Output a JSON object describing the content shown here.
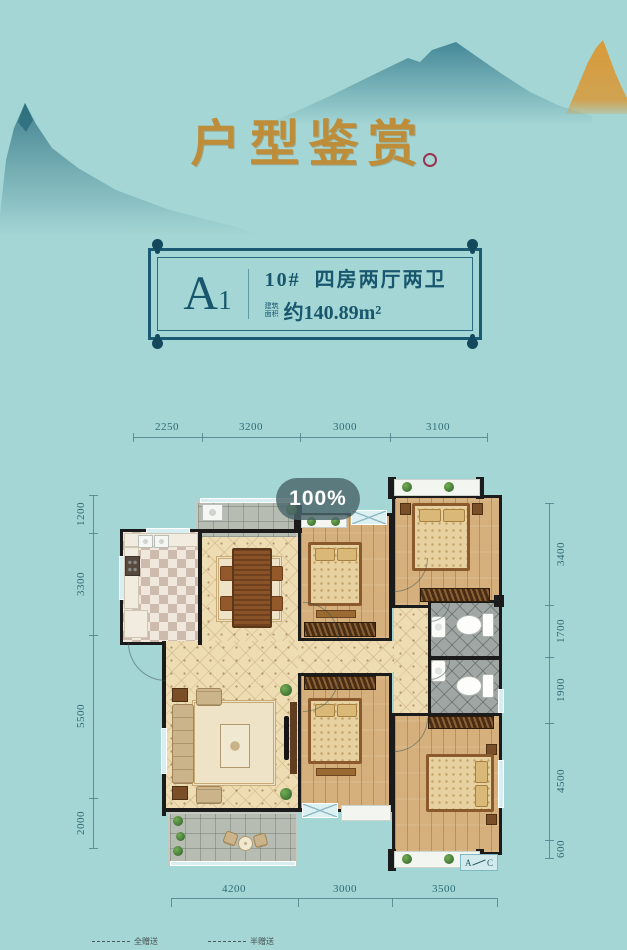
{
  "page": {
    "background": "#a4d6d5",
    "accent_gold": "#bd8d3a",
    "ink_teal": "#17566c"
  },
  "header": {
    "title": "户型鉴赏"
  },
  "unit_card": {
    "code_main": "A",
    "code_sub": "1",
    "title": "10#  四房两厅两卫",
    "area_label_line1": "建筑",
    "area_label_line2": "面积",
    "area_value": "约140.89m²"
  },
  "loader": {
    "progress": "100%"
  },
  "plan": {
    "dims_top": [
      "2250",
      "3200",
      "3000",
      "3100"
    ],
    "dims_left": [
      "1200",
      "3300",
      "5500",
      "2000"
    ],
    "dims_right": [
      "3400",
      "1700",
      "1900",
      "4500",
      "600"
    ],
    "dims_bottom": [
      "4200",
      "3000",
      "3500"
    ],
    "section_marker": {
      "left": "A",
      "right": "C"
    },
    "legend": {
      "full": "全赠送",
      "half": "半赠送"
    }
  }
}
